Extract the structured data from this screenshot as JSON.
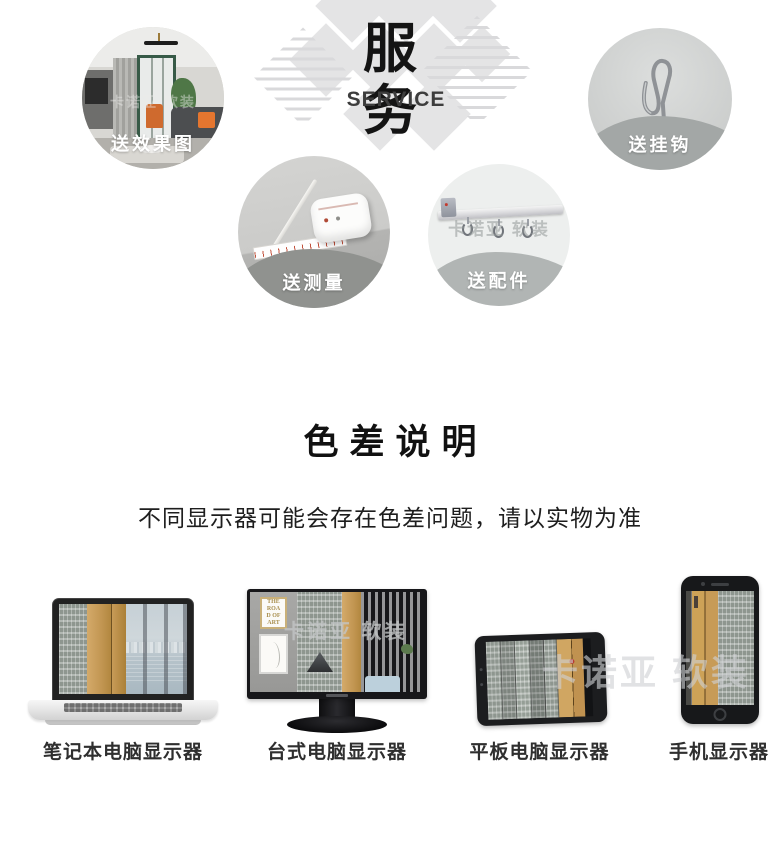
{
  "brand_watermark": "卡诺亚 软装",
  "service": {
    "title": "服务",
    "subtitle": "SERVICE",
    "items": [
      {
        "id": "effect-render",
        "label": "送效果图"
      },
      {
        "id": "measure",
        "label": "送测量"
      },
      {
        "id": "accessories",
        "label": "送配件"
      },
      {
        "id": "hooks",
        "label": "送挂钩"
      }
    ]
  },
  "color_note": {
    "title": "色差说明",
    "text": "不同显示器可能会存在色差问题，请以实物为准"
  },
  "devices": [
    {
      "type": "laptop",
      "label": "笔记本电脑显示器"
    },
    {
      "type": "desktop-monitor",
      "label": "台式电脑显示器"
    },
    {
      "type": "tablet",
      "label": "平板电脑显示器"
    },
    {
      "type": "phone",
      "label": "手机显示器"
    }
  ],
  "monitor_screen": {
    "frame_text": "THE ROAD OF ART"
  },
  "colors": {
    "gold_curtain": "#c49a5b",
    "gray_curtain": "#8e968f",
    "wave_gray": "#a3a7a6",
    "pattern_gray": "#e4e4e5",
    "title_text": "#141414",
    "label_white": "#ffffff"
  }
}
